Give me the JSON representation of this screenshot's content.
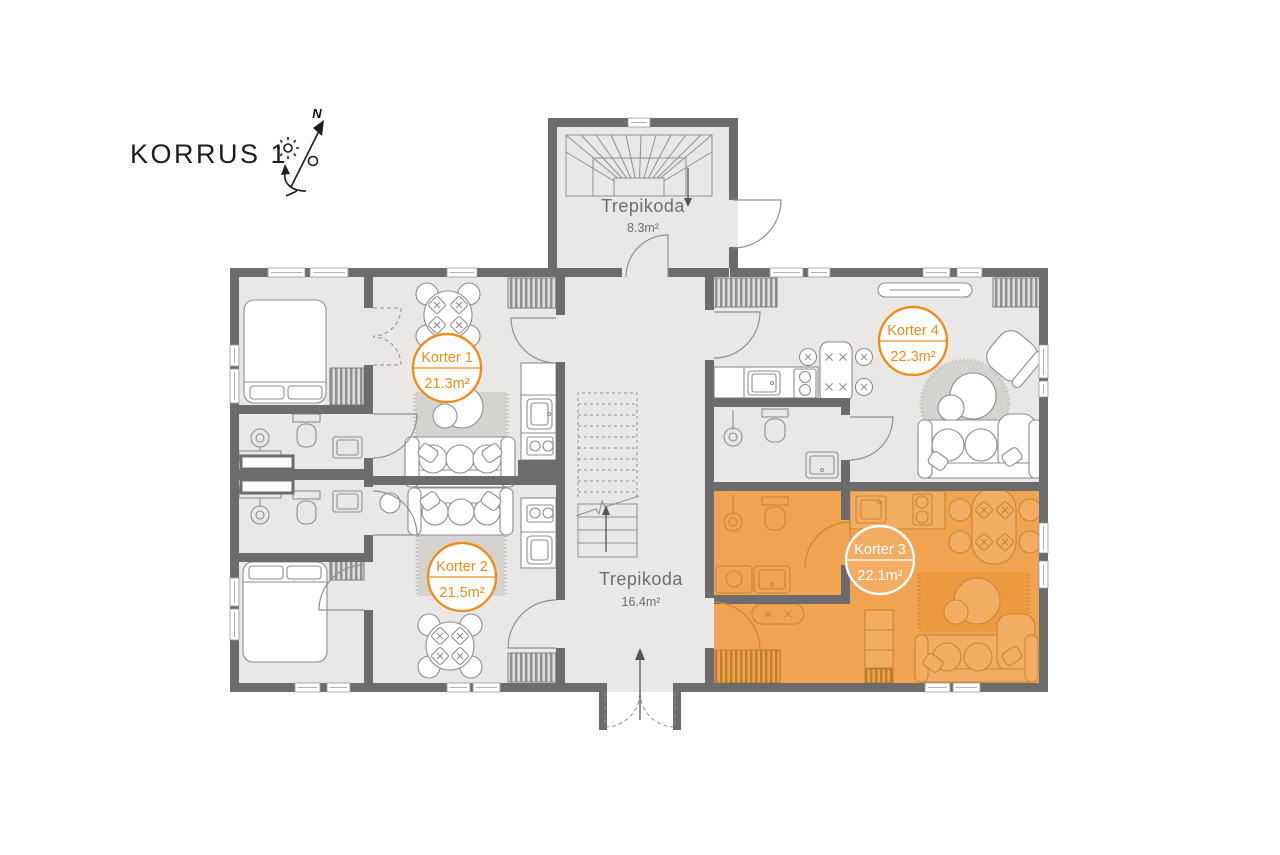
{
  "title": "KORRUS 1",
  "compass": {
    "north_label": "N"
  },
  "staircases": [
    {
      "name": "Trepikoda",
      "area": "8.3m²"
    },
    {
      "name": "Trepikoda",
      "area": "16.4m²"
    }
  ],
  "apartments": [
    {
      "name": "Korter 1",
      "area": "21.3m²",
      "highlighted": false
    },
    {
      "name": "Korter 2",
      "area": "21.5m²",
      "highlighted": false
    },
    {
      "name": "Korter 3",
      "area": "22.1m²",
      "highlighted": true
    },
    {
      "name": "Korter 4",
      "area": "22.3m²",
      "highlighted": false
    }
  ],
  "colors": {
    "accent": "#f18c1a",
    "wall": "#6c6c6c",
    "floor": "#e9e8e6",
    "highlight_fill": "#f0a351",
    "highlight_light": "#f3ad63",
    "line": "#8d8d8d",
    "line_orange": "#c9862e",
    "rug": "#d4d3d0",
    "rug_orange": "#eb9a40",
    "background": "#ffffff"
  }
}
